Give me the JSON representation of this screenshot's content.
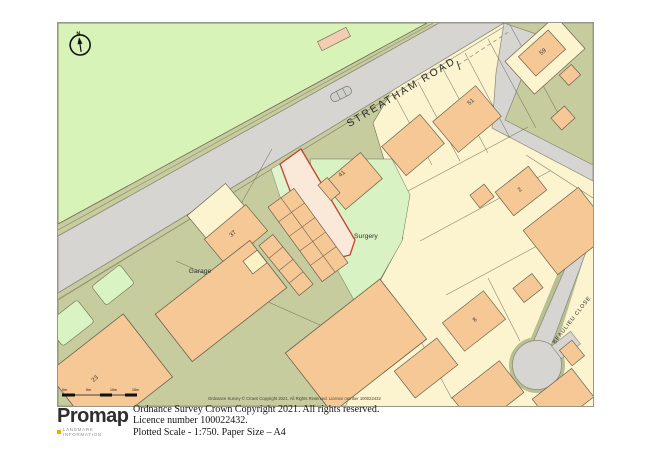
{
  "map": {
    "road_labels": {
      "streatham": "STREATHAM ROAD",
      "beaulieu": "BEAULIEU CLOSE"
    },
    "place_labels": {
      "surgery": "Surgery",
      "garage": "Garage"
    },
    "plot_numbers": {
      "n59": "59",
      "n51": "51",
      "n41": "41",
      "n37": "37",
      "n23": "23",
      "n8": "8",
      "n2": "2"
    },
    "compass": {
      "north_label": "N"
    },
    "scale_bar": {
      "labels": [
        "0m",
        "5m",
        "10m",
        "15m"
      ]
    },
    "inner_copyright": "Ordnance Survey © Crown Copyright 2021. All Rights Reserved. Licence number 100022432",
    "colors": {
      "field_green": "#d8f3b8",
      "garden_green": "#d9f2c4",
      "olive_background": "#c6cc9d",
      "road_gray": "#d6d5d2",
      "plot_cream": "#fbf4cf",
      "building_orange": "#f6c895",
      "building_pale": "#fdf2c3",
      "site_boundary_red": "#c8402e"
    }
  },
  "footer": {
    "logo_text": "Promap",
    "logo_subtext": "LANDMARK INFORMATION",
    "line1": "Ordnance Survey Crown Copyright 2021. All rights reserved.",
    "line2": "Licence number 100022432.",
    "line3": "Plotted Scale - 1:750. Paper Size – A4"
  }
}
